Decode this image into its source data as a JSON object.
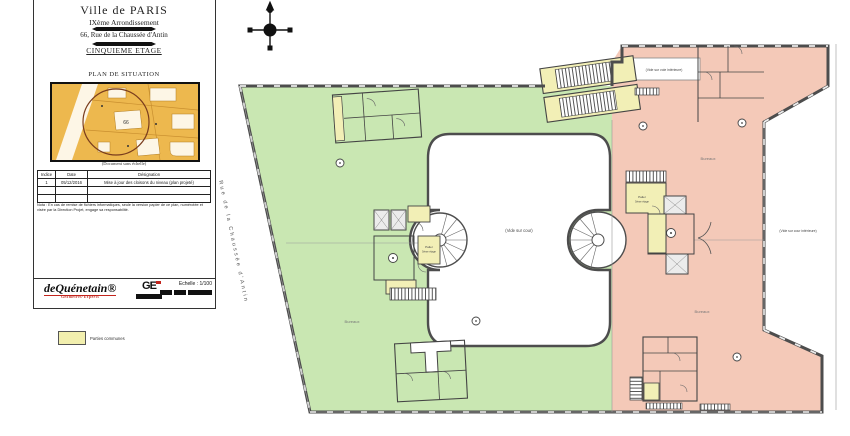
{
  "title_block": {
    "commune": "Ville de PARIS",
    "arrondissement": "IXème Arrondissement",
    "address": "66, Rue de la Chaussée d'Antin",
    "floor_title": "CINQUIEME ETAGE",
    "situation": {
      "title": "PLAN DE SITUATION",
      "caption": "(Document sans échelle)",
      "parcel_number": "66"
    },
    "revision_table": {
      "headers": [
        "Indice",
        "Date",
        "Désignation"
      ],
      "rows": [
        {
          "indice": "1",
          "date": "05/12/2016",
          "designation": "Mise à jour des cloisons du niveau (plan projeté)"
        }
      ]
    },
    "nota": "Nota : En cas de remise de fichiers informatiques, seule la version papier de ce plan, numérotée et visée par la Direction Projet, engage sa responsabilité.",
    "logos": {
      "primary": "deQuénetain®",
      "primary_sub": "Géomètres-Experts",
      "secondary": "GE"
    },
    "scale_label": "Echelle : 1/100",
    "legend": {
      "swatch_color": "#f2efae",
      "label": "Parties communes"
    }
  },
  "plan": {
    "street_label": "Rue de la Chaussée d'Antin",
    "labels": {
      "courtyard": "(Vide sur cour)",
      "top_void": "(Vide sur voie intérieure)",
      "right_void": "(Vide sur cour intérieure)",
      "left_landing": "Palier",
      "left_landing_sub": "5ème étage",
      "right_landing": "Palier",
      "right_landing_sub": "5ème étage",
      "green_zone": "Bureaux",
      "pink_zone_top": "Bureaux",
      "pink_zone_bottom": "Bureaux"
    },
    "colors": {
      "offices_left": "#c9e7b2",
      "offices_right": "#f4c9b8",
      "common_parts": "#f2efb6",
      "walls": "#4d4d4d",
      "situation_map": "#edb84e"
    }
  }
}
